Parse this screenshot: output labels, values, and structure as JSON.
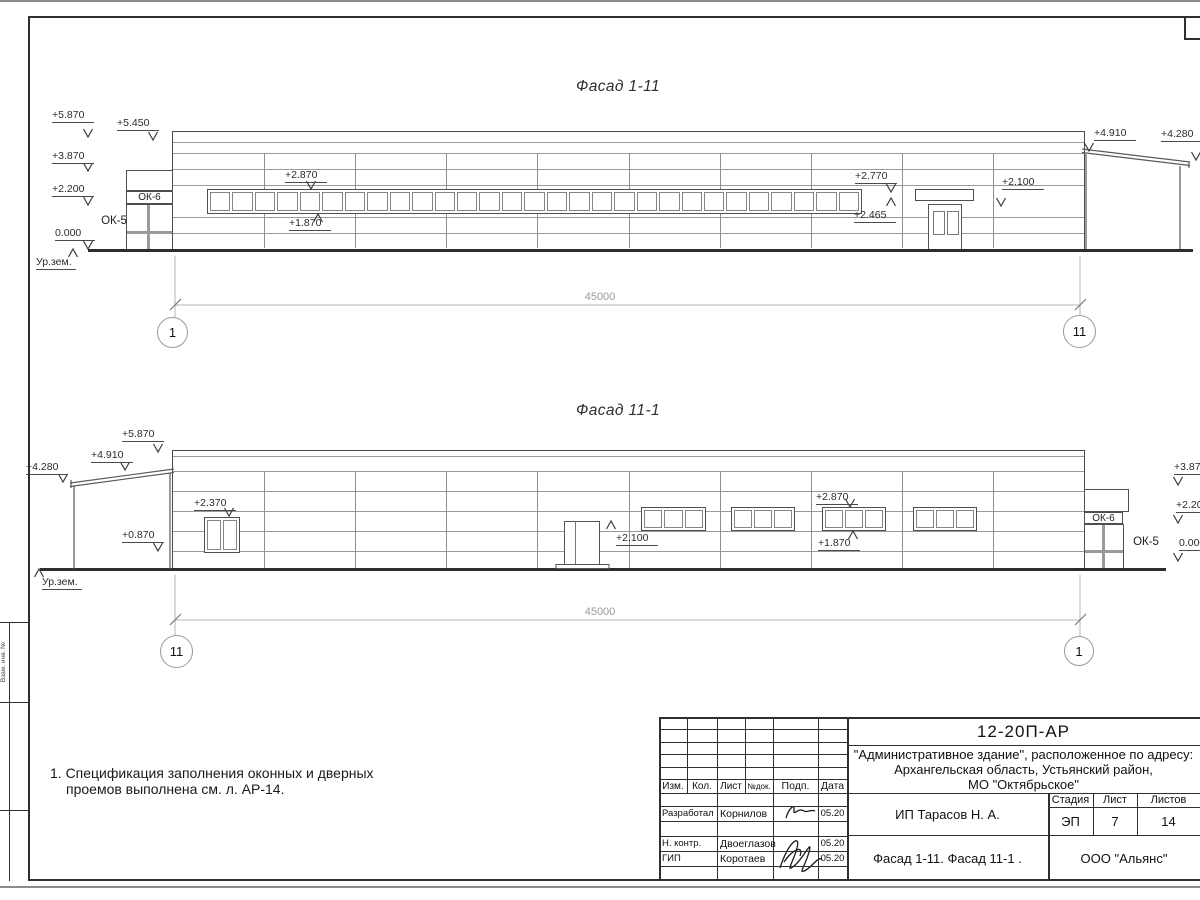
{
  "f1": {
    "title": "Фасад 1-11",
    "elev_5870": "+5.870",
    "elev_5450": "+5.450",
    "elev_3870": "+3.870",
    "elev_2200": "+2.200",
    "elev_0000": "0.000",
    "ground_label": "Ур.зем.",
    "ok5": "ОК-5",
    "ok6": "ОК-6",
    "elev_2870": "+2.870",
    "elev_1870": "+1.870",
    "elev_2770": "+2.770",
    "elev_2465": "+2.465",
    "elev_2100": "+2.100",
    "elev_4910": "+4.910",
    "elev_4280": "+4.280",
    "dim": "45000",
    "axis_left": "1",
    "axis_right": "11"
  },
  "f2": {
    "title": "Фасад 11-1",
    "elev_5870": "+5.870",
    "elev_4910": "+4.910",
    "elev_4280": "+4.280",
    "elev_2370": "+2.370",
    "elev_0870": "+0.870",
    "ground_label": "Ур.зем.",
    "elev_2100": "+2.100",
    "elev_2870": "+2.870",
    "elev_1870": "+1.870",
    "ok6": "ОК-6",
    "ok5": "ОК-5",
    "elev_3870": "+3.870",
    "elev_2200": "+2.200",
    "elev_0000": "0.000",
    "dim": "45000",
    "axis_left": "11",
    "axis_right": "1"
  },
  "note": {
    "line1": "1. Спецификация заполнения оконных и дверных",
    "line2": "проемов выполнена см. л. АР-14."
  },
  "titleblock": {
    "doc_code": "12-20П-АР",
    "address1": "\"Административное здание\", расположенное по адресу:",
    "address2": "Архангельская область, Устьянский район,",
    "address3": "МО \"Октябрьское\"",
    "col_izm": "Изм.",
    "col_kol": "Кол.",
    "col_list": "Лист",
    "col_ndoc": "№док.",
    "col_podp": "Подп.",
    "col_data": "Дата",
    "rows": [
      {
        "role": "Разработал",
        "name": "Корнилов",
        "date": "05.20"
      },
      {
        "role": "Н. контр.",
        "name": "Двоеглазов",
        "date": "05.20"
      },
      {
        "role": "ГИП",
        "name": "Коротаев",
        "date": "05.20"
      }
    ],
    "client": "ИП Тарасов Н. А.",
    "stage_h": "Стадия",
    "sheet_h": "Лист",
    "sheets_h": "Листов",
    "stage": "ЭП",
    "sheet_no": "7",
    "sheets_total": "14",
    "sheet_title": "Фасад 1-11. Фасад 11-1 .",
    "org": "ООО \"Альянс\""
  },
  "margin": {
    "label": "Взам. инв. №"
  }
}
